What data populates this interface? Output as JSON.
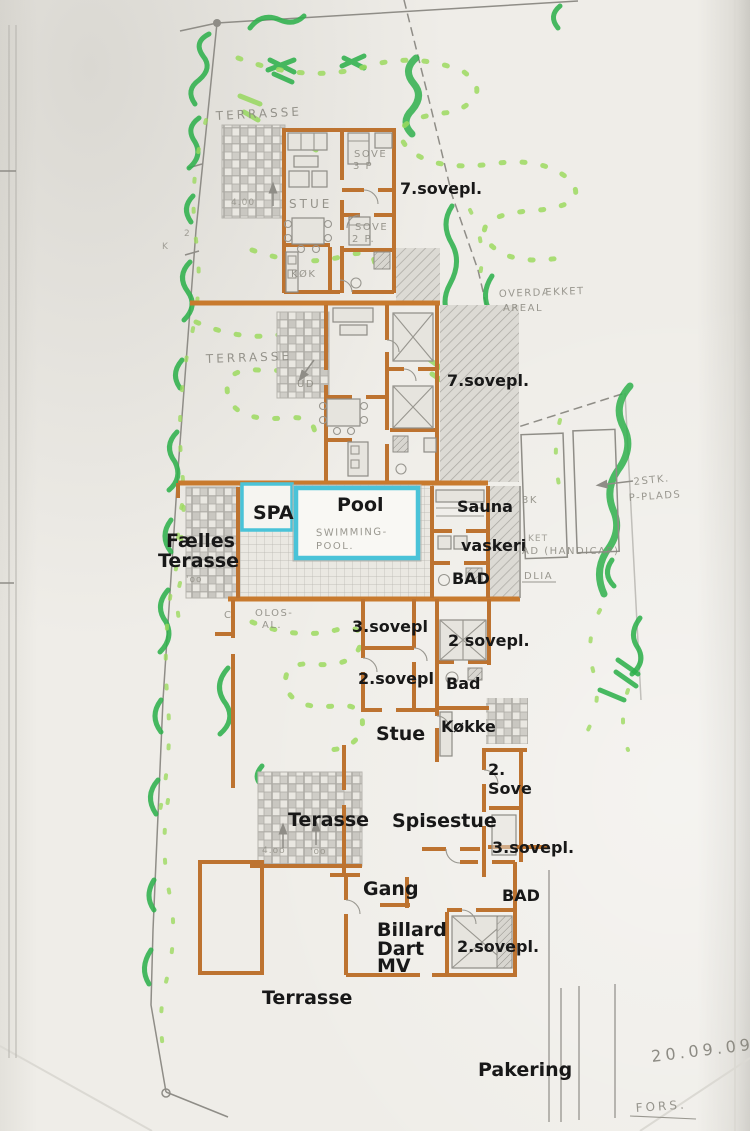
{
  "colors": {
    "paper": "#eeece7",
    "wall_orange": "#bd7330",
    "wall_orange_bright": "#c87a2e",
    "pool_cyan": "#4ac3d8",
    "marker_green": "#2fb04c",
    "marker_green_light": "#97d75e",
    "pencil_gray": "#8f8d87",
    "typed_text": "#181818"
  },
  "typed": {
    "sovepl7_top": "7.sovepl.",
    "sovepl7_mid": "7.sovepl.",
    "spa": "SPA",
    "pool": "Pool",
    "sauna": "Sauna",
    "vaskeri": "vaskeri",
    "bad_pool": "BAD",
    "faelles_line1": "Fælles",
    "faelles_line2": "Terasse",
    "sovepl3_a": "3.sovepl",
    "sovepl2_right": "2 sovepl.",
    "sovepl2_a": "2.sovepl",
    "bad_small": "Bad",
    "stue": "Stue",
    "koekken": "Køkke",
    "sove2_line1": "2.",
    "sove2_line2": "Sove",
    "terasse_mid": "Terasse",
    "spisestue": "Spisestue",
    "sovepl3_b": "3.sovepl.",
    "gang": "Gang",
    "bad_lower": "BAD",
    "billard_line1": "Billard",
    "billard_line2": "Dart",
    "billard_line3": "MV",
    "sovepl2_b": "2.sovepl.",
    "terrasse_bottom": "Terrasse",
    "pakering": "Pakering"
  },
  "handwritten": {
    "terrasse_top": "TERRASSE",
    "dim_top": "4.00",
    "stue": "STUE",
    "sove3p_line1": "SOVE",
    "sove3p_line2": "3 P",
    "sove2p_line1": "SOVE",
    "sove2p_line2": "2 P.",
    "koek": "KØK",
    "terrasse_mid": "TERRASSE",
    "ud": "UD",
    "overdaekket_line1": "OVERDÆKKET",
    "overdaekket_line2": "AREAL",
    "swimming_line1": "SWIMMING-",
    "swimming_line2": "POOL.",
    "k3": "3K",
    "ket": "KET",
    "handicap": "AD (HANDICAP)",
    "dlia": "DLIA",
    "stk2": "2STK.",
    "pplads": "P-PLADS",
    "c_mark": "C",
    "olos_line1": "OLOS-",
    "olos_line2": "AL.",
    "dim_mid": "'oo",
    "dim_bot_1": "4.oo",
    "dim_bot_2": "'oo",
    "mark_2": "2",
    "mark_k": "K",
    "date": "20.09.09",
    "fors": "FORS."
  }
}
